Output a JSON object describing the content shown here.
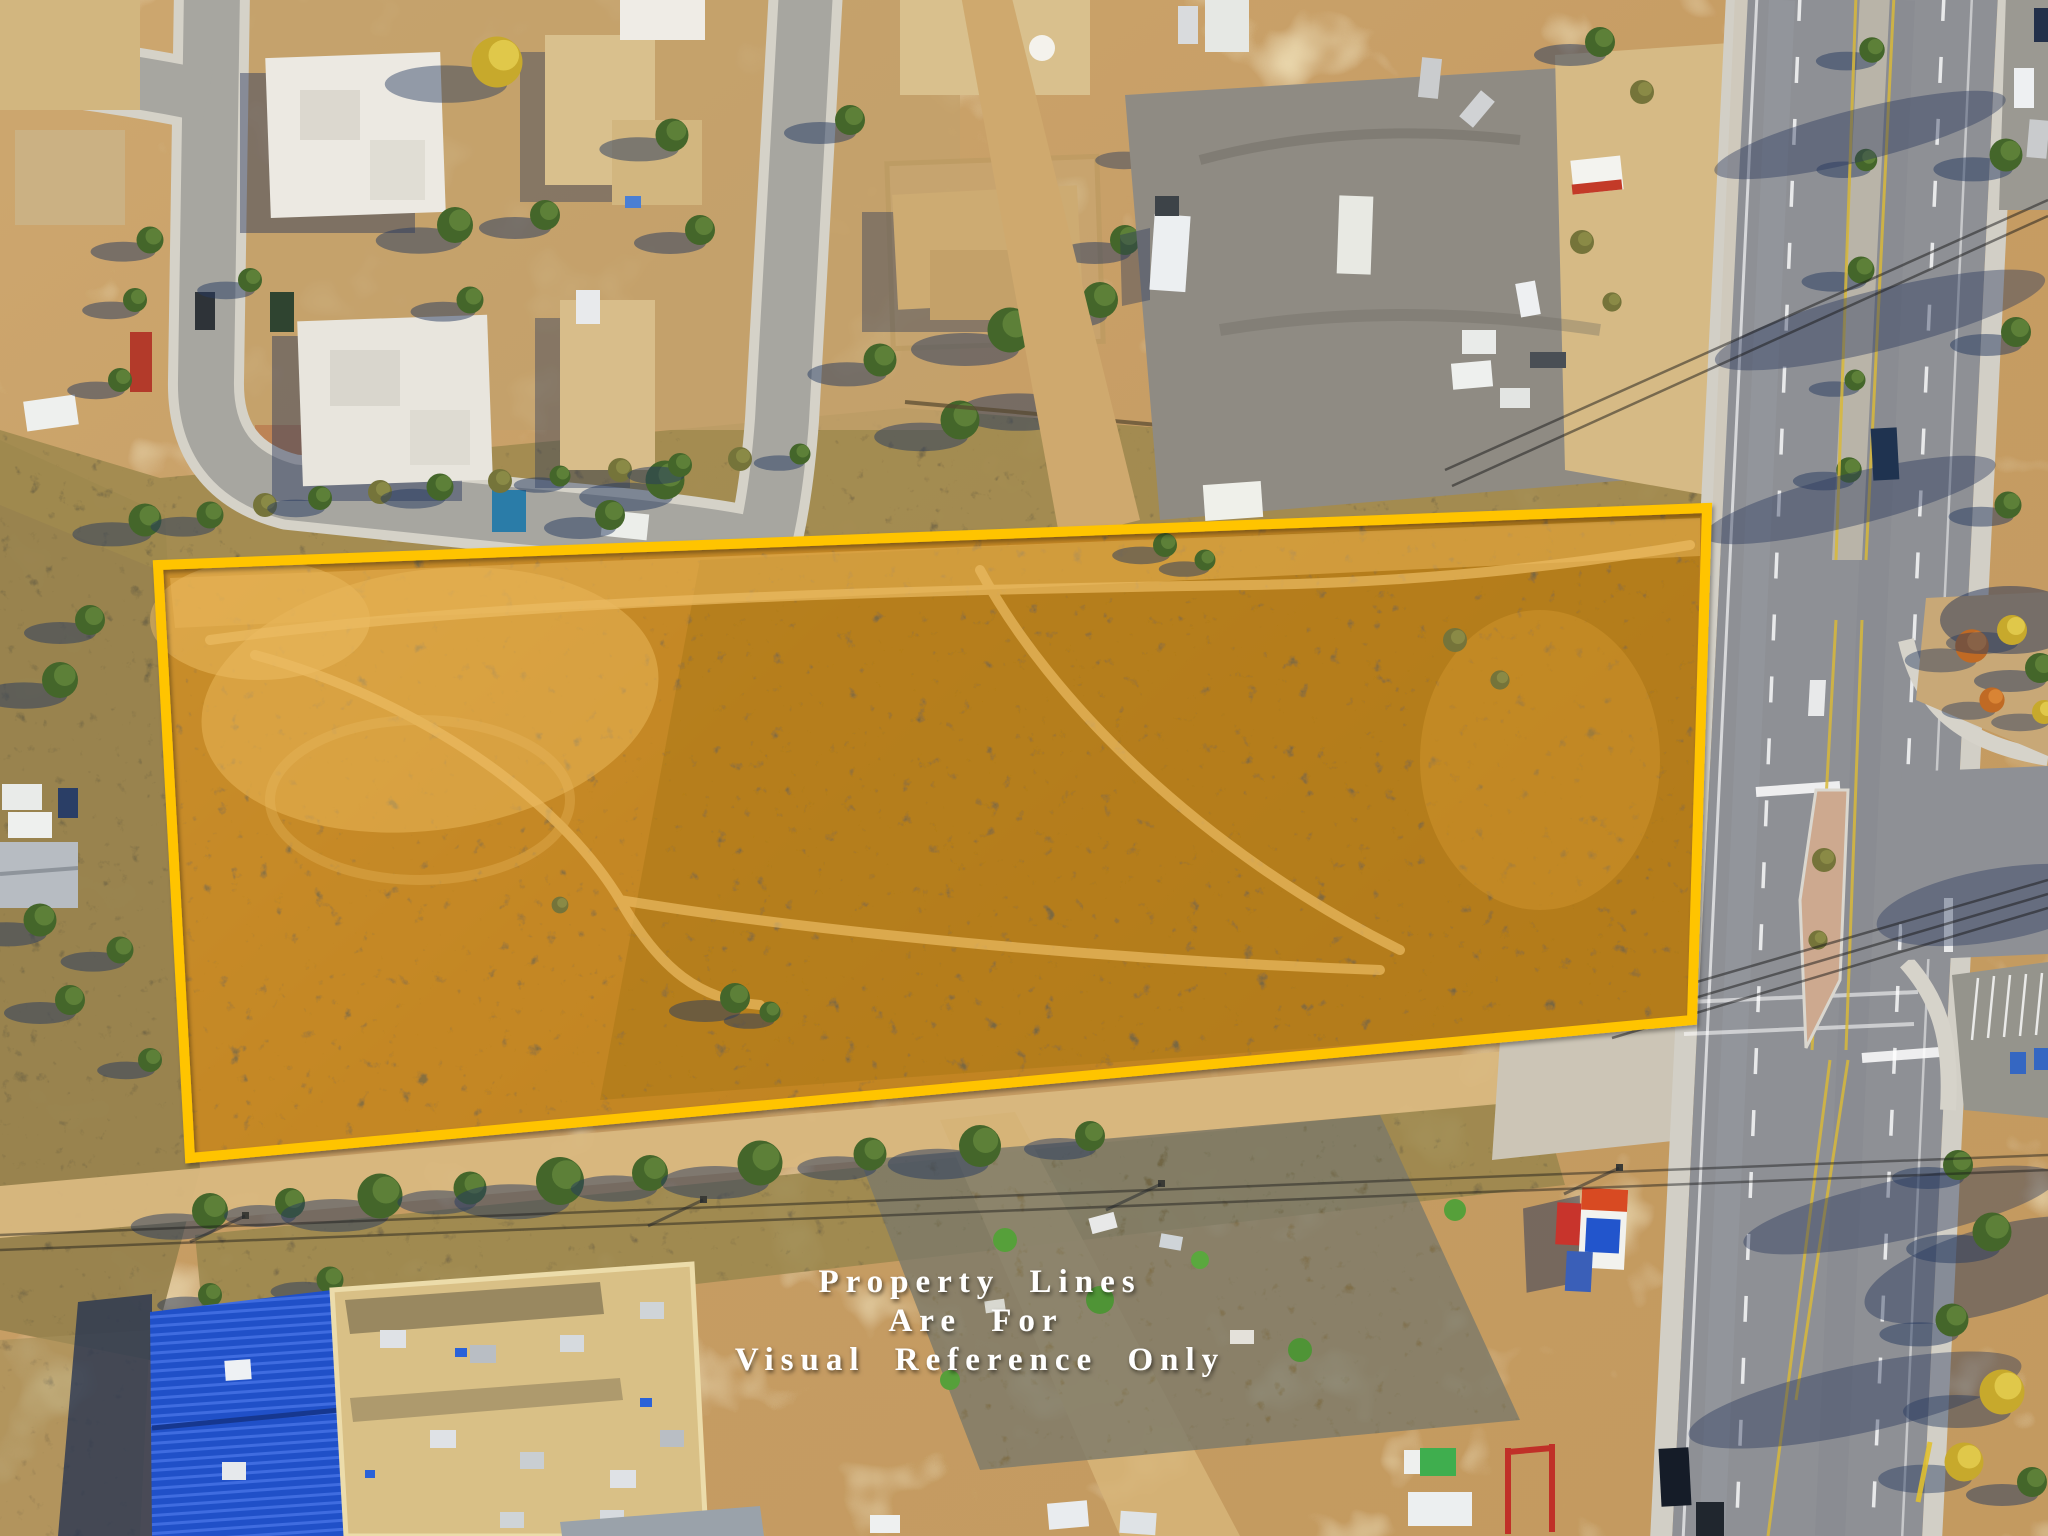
{
  "overlay_text": {
    "line1": "Property Lines",
    "line2": "Are For",
    "line3": "Visual Reference Only",
    "color": "#ffffff"
  },
  "property_boundary": {
    "stroke_color": "#ffc400",
    "fill_tint": "#d8962a"
  },
  "palette": {
    "dirt": "#c9a06a",
    "scrub": "#97824d",
    "road_asphalt": "#8e9095",
    "neighborhood_street": "#a7a6a0",
    "sidewalk": "#d2cfc6",
    "median_island_pink": "#cdа98f",
    "roof_white": "#ece9e2",
    "roof_tan": "#d9c086",
    "roof_blue": "#2050c8",
    "tree_green": "#44662a",
    "tree_yellow": "#c7a92c",
    "tree_orange": "#c06a24",
    "shadow_blue": "#263a5f"
  }
}
